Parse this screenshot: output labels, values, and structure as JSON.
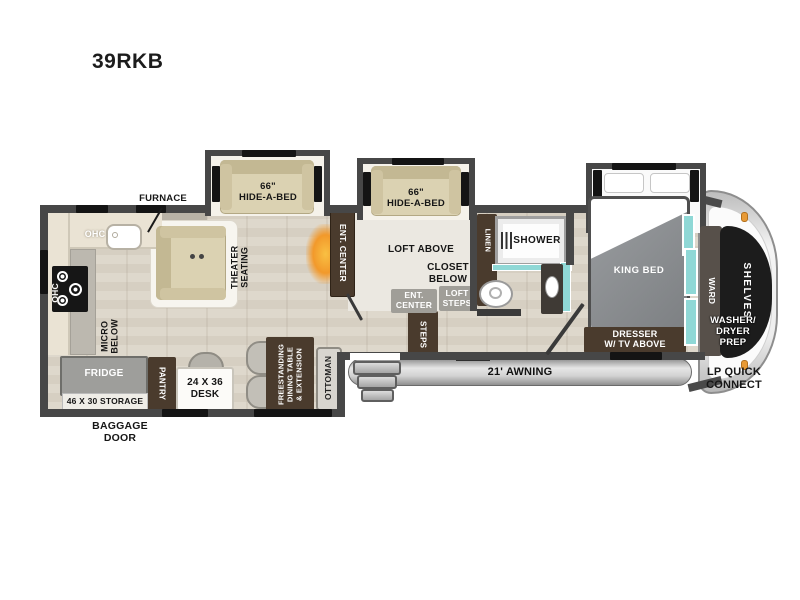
{
  "title": "39RKB",
  "colors": {
    "wall": "#474747",
    "brown": "#4a3b2d",
    "teal": "#8fd8d6",
    "tan": "#dbd2b2",
    "tandark": "#c3b893",
    "orange": "#f0a02e"
  },
  "labels": {
    "furnace": "FURNACE",
    "ohc_rear": "OHC",
    "ohc_side": "OHC",
    "hide_a_bed_1": "66\"\nHIDE-A-BED",
    "hide_a_bed_2": "66\"\nHIDE-A-BED",
    "theater_seating": "THEATER\nSEATING",
    "ent_center_fireplace": "ENT. CENTER",
    "loft_above": "LOFT ABOVE",
    "closet_below": "CLOSET\nBELOW",
    "ent_center_loft": "ENT.\nCENTER",
    "loft_steps": "LOFT\nSTEPS",
    "steps": "STEPS",
    "linen": "LINEN",
    "shower": "SHOWER",
    "king_bed": "KING BED",
    "ward": "WARD",
    "shelves": "SHELVES",
    "washer_dryer_prep": "WASHER/\nDRYER\nPREP",
    "dresser": "DRESSER\nW/ TV ABOVE",
    "awning": "21' AWNING",
    "lp_quick_connect": "LP QUICK\nCONNECT",
    "micro_below": "MICRO\nBELOW",
    "fridge": "FRIDGE",
    "pantry": "PANTRY",
    "storage": "46 X 30 STORAGE",
    "baggage_door": "BAGGAGE\nDOOR",
    "desk": "24 X 36\nDESK",
    "dining_table": "FREESTANDING\nDINING TABLE\n& EXTENSION",
    "ottoman": "OTTOMAN"
  }
}
